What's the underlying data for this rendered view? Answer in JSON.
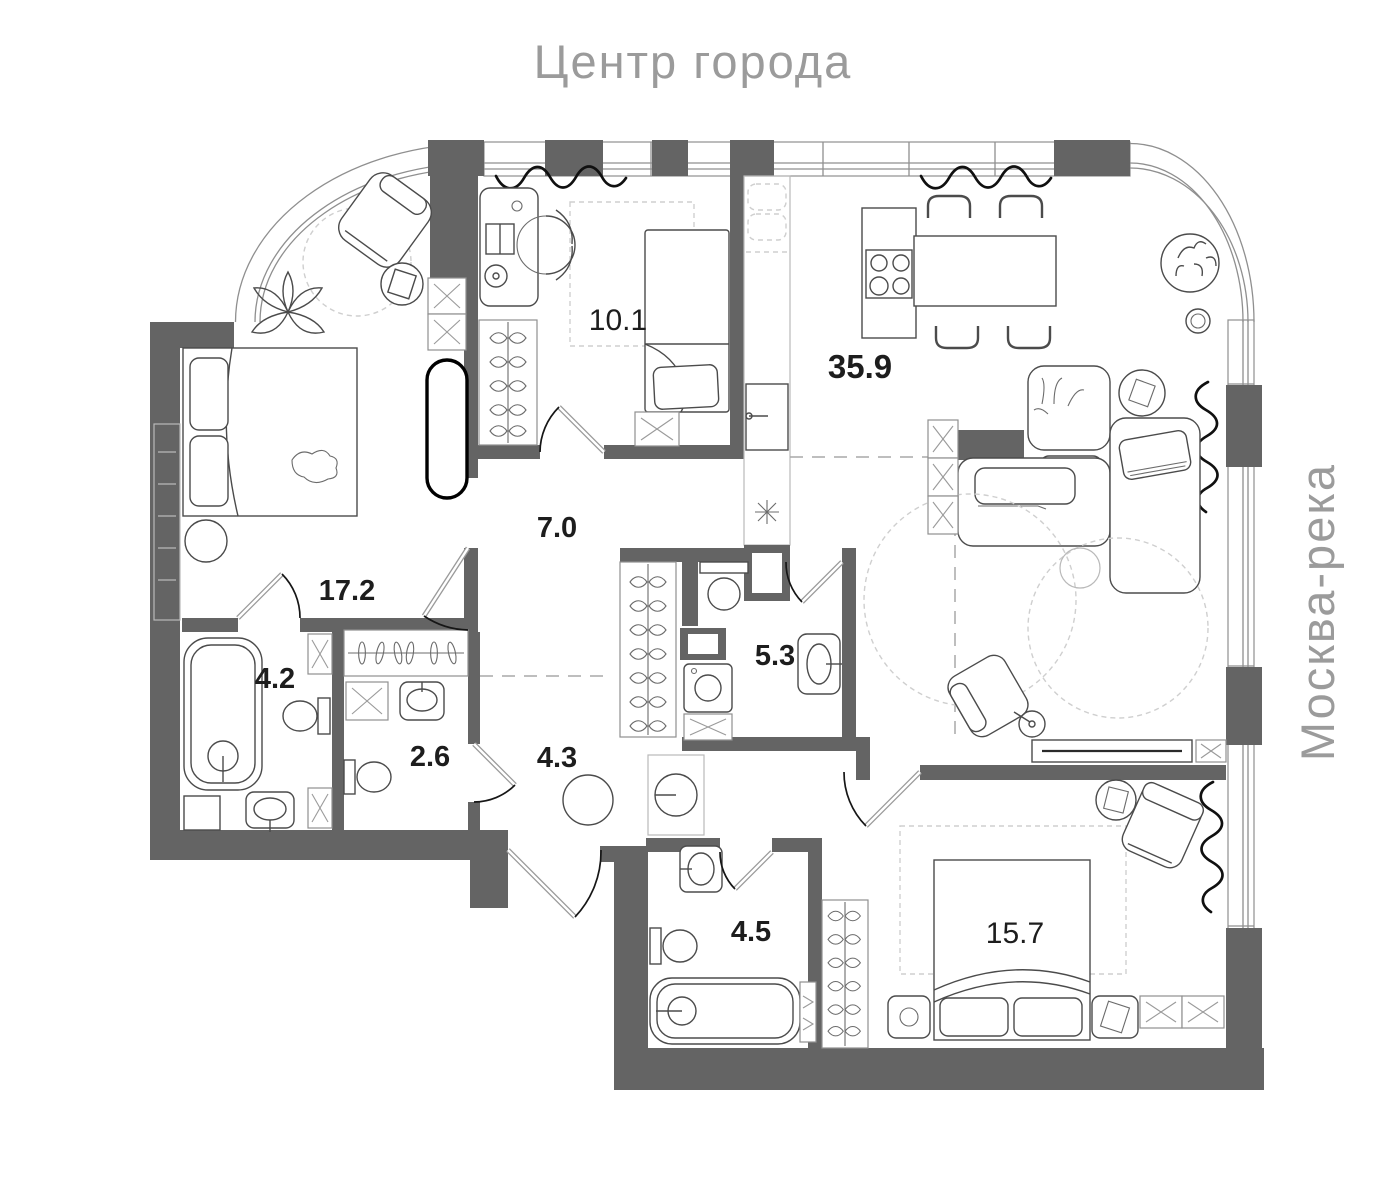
{
  "header": {
    "title": "Центр города"
  },
  "side": {
    "river_label": "Москва-река"
  },
  "rooms": {
    "living": {
      "kind": "kitchen-living-room",
      "area": "35.9"
    },
    "child": {
      "kind": "bedroom-small",
      "area": "10.1"
    },
    "master": {
      "kind": "bedroom-master",
      "area": "17.2"
    },
    "hall": {
      "kind": "hallway",
      "area": "7.0"
    },
    "bath1": {
      "kind": "bathroom",
      "area": "4.2"
    },
    "wc": {
      "kind": "wc",
      "area": "2.6"
    },
    "corridor": {
      "kind": "corridor",
      "area": "4.3"
    },
    "bath2": {
      "kind": "bathroom",
      "area": "5.3"
    },
    "bath3": {
      "kind": "bathroom",
      "area": "4.5"
    },
    "bedroom": {
      "kind": "bedroom",
      "area": "15.7"
    }
  },
  "colors": {
    "wall": "#646464",
    "muted_text": "#9b9b9b",
    "area_text": "#1d1d1d",
    "curtain": "#101010"
  }
}
